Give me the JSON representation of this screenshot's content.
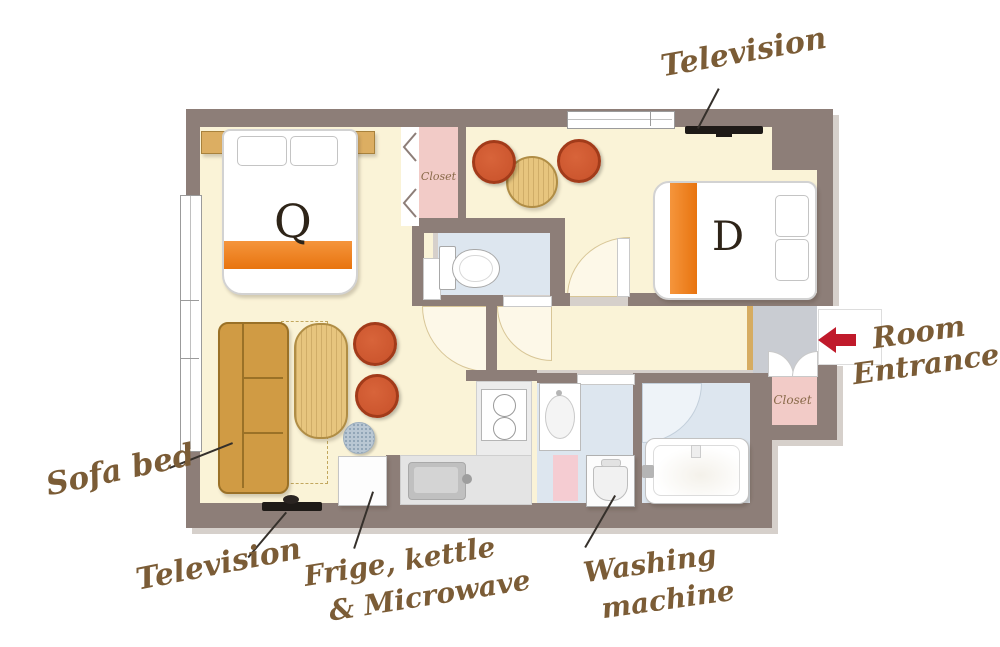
{
  "title": "Apartment floor plan",
  "labels": {
    "television_top": "Television",
    "television_bottom": "Television",
    "sofa_bed": "Sofa bed",
    "fridge_line1": "Frige, kettle",
    "fridge_line2": "& Microwave",
    "washing_line1": "Washing",
    "washing_line2": "machine",
    "room_entrance_line1": "Room",
    "room_entrance_line2": "Entrance",
    "closet_top": "Closet",
    "closet_entrance": "Closet",
    "bed_queen": "Q",
    "bed_double": "D"
  },
  "icons": {
    "entrance_arrow": "red-left-arrow"
  },
  "colors": {
    "wall": "#8d7e78",
    "wall-shadow": "#d6d0cb",
    "floor-cream": "#faf3d7",
    "floor-blue": "#dde6ef",
    "floor-pink": "#f2cbc7",
    "floor-entry": "#c9ccd2",
    "accent-orange": "#e8740f",
    "chair-red": "#c8512a",
    "wood": "#e7c57e",
    "sofa": "#d09b44",
    "label-brown": "#7b5c36",
    "arrow-red": "#c01a2b"
  }
}
